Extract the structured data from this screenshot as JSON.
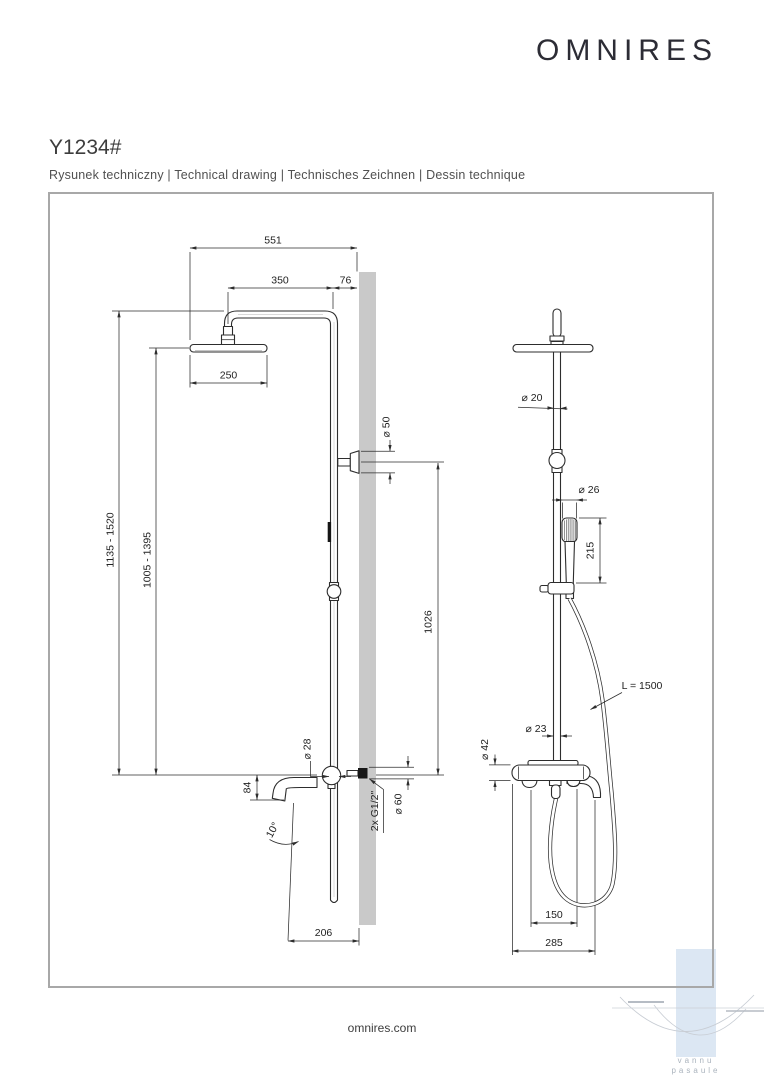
{
  "header": {
    "logo": "OMNIRES",
    "product_code": "Y1234#",
    "subtitle": "Rysunek techniczny  |  Technical drawing  |  Technisches Zeichnen  |  Dessin technique"
  },
  "footer": {
    "website": "omnires.com"
  },
  "watermark": {
    "line1": "vannu",
    "line2": "pasaule"
  },
  "drawing": {
    "side_view": {
      "d551": "551",
      "d350": "350",
      "d76": "76",
      "d250": "250",
      "h_range_outer": "1135 - 1520",
      "h_range_inner": "1005 - 1395",
      "dia50": "⌀ 50",
      "d1026": "1026",
      "dia28": "⌀ 28",
      "d84": "84",
      "a10": "10°",
      "g12": "2x G1/2\"",
      "dia60": "⌀ 60",
      "d206": "206"
    },
    "front_view": {
      "dia20": "⌀ 20",
      "dia26": "⌀ 26",
      "d215": "215",
      "l1500": "L = 1500",
      "dia23": "⌀ 23",
      "dia42": "⌀ 42",
      "d150": "150",
      "d285": "285"
    }
  },
  "colors": {
    "wall": "#c9c9c9",
    "line": "#2d2d2d",
    "frame_border": "#a8a8a8",
    "watermark_blue": "#dce7f3",
    "watermark_text": "#aab3bd"
  }
}
